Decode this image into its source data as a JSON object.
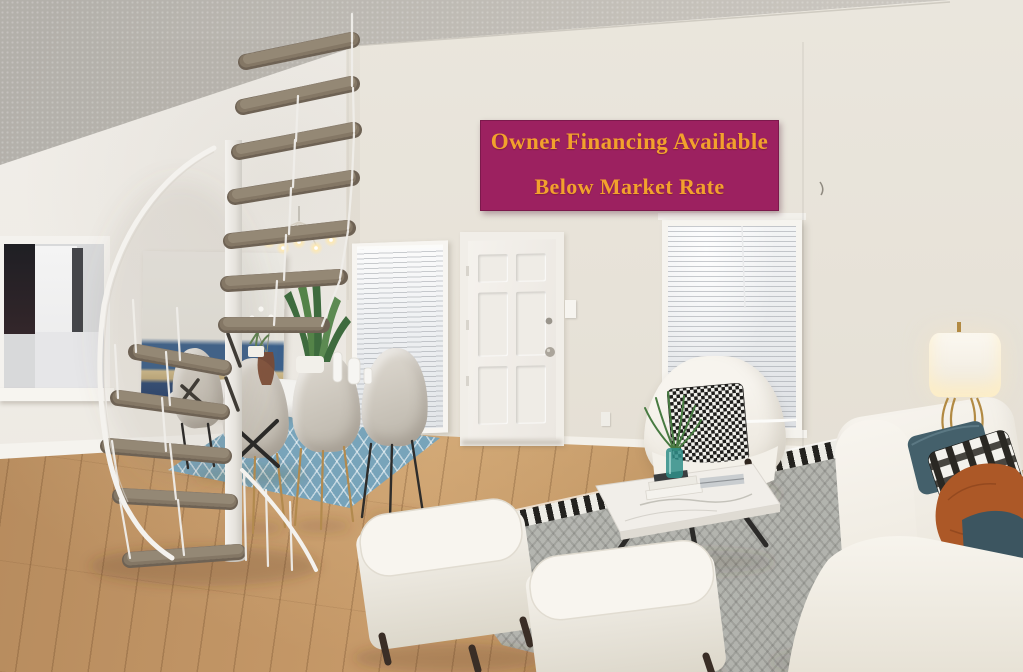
{
  "banner": {
    "line1": "Owner Financing Available",
    "line2": "Below Market Rate",
    "background_color": "#9C2160",
    "text_color": "#F2A12D"
  },
  "scene": {
    "description": "Virtually staged condo living/dining room: white spiral staircase with carpeted treads, dining table with four upholstered chairs on a blue trellis rug, white six-panel entry door, two windows with white mini blinds, pass-through opening to kitchen, abstract painting, white sofa with teal/plaid/rust pillows, white barrel armchair with houndstooth pillow, marble coffee table with books and plant, two white ottomans on a gray chevron rug, brass table lamp, hardwood floor, vaulted textured ceiling.",
    "colors": {
      "wall": "#E9E5DC",
      "ceiling": "#BDB9B3",
      "floor_wood": "#B98E60",
      "dining_rug": "#7BA6BC",
      "living_rug": "#B6B7B1",
      "upholstery_white": "#F4F1EA",
      "pillow_teal": "#44606B",
      "pillow_rust": "#AC5827",
      "stair_carpet": "#7E7263",
      "stair_rail": "#F2F0EC"
    }
  }
}
